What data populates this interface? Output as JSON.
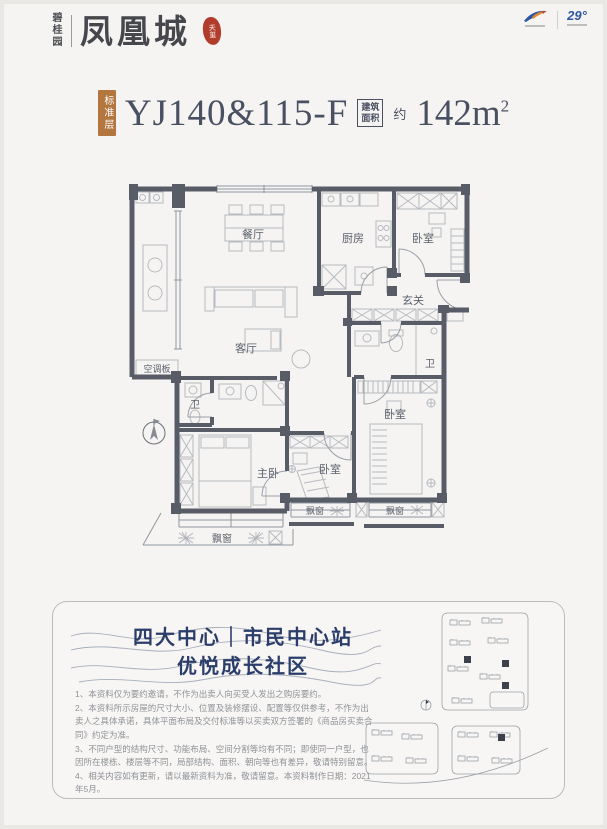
{
  "brand": {
    "name_vertical": "碧桂园",
    "name_main": "凤凰城",
    "seal": "天玺"
  },
  "top_right": {
    "degree_logo": "29°"
  },
  "title": {
    "badge": "标准层",
    "model": "YJ140&115-F",
    "area_label_line1": "建筑",
    "area_label_line2": "面积",
    "approx": "约",
    "area_value": "142m",
    "area_exponent": "2"
  },
  "floorplan": {
    "rooms": {
      "dining": "餐厅",
      "kitchen": "厨房",
      "bedroom_top": "卧室",
      "foyer": "玄关",
      "bath_main": "卫",
      "bath_master": "卫",
      "living": "客厅",
      "master": "主卧",
      "bedroom_mid": "卧室",
      "bedroom_right": "卧室",
      "ac_panel": "空调板",
      "bay_master": "飘窗",
      "bay_mid": "飘窗",
      "bay_right": "飘窗"
    }
  },
  "promo": {
    "headline_line1": "四大中心｜市民中心站",
    "headline_line2": "优悦成长社区",
    "disclaimers": [
      "1、本资料仅为要约邀请，不作为出卖人向买受人发出之购房要约。",
      "2、本资料所示房屋的尺寸大小、位置及装修摆设、配置等仅供参考，不作为出卖人之具体承诺，具体平面布局及交付标准等以买卖双方签署的《商品房买卖合同》约定为准。",
      "3、不同户型的结构尺寸、功能布局、空间分割等均有不同；即使同一户型，也因所在楼栋、楼层等不同，局部结构、面积、朝向等也有差异，敬请特别留意。",
      "4、相关内容如有更新，请以最新资料为准，敬请留意。本资料制作日期：2021年5月。"
    ]
  },
  "colors": {
    "wall": "#575c67",
    "badge": "#b2763e",
    "seal": "#b23c2b",
    "headline": "#2b3d6a",
    "title_text": "#495061"
  }
}
